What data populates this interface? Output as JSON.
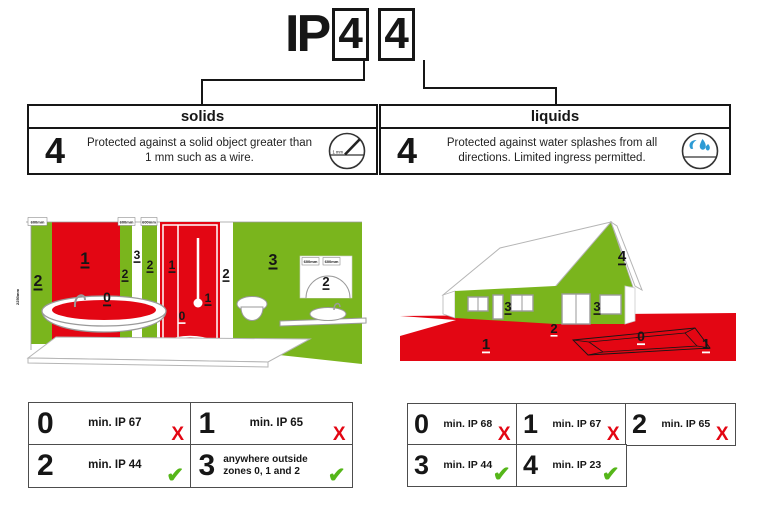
{
  "colors": {
    "red": "#e30613",
    "green": "#7ab51d",
    "blue": "#2d9bd5",
    "check_green": "#55b619",
    "cross_red": "#e30613"
  },
  "title": {
    "prefix": "IP",
    "digit_solids": "4",
    "digit_liquids": "4"
  },
  "panels": {
    "solids": {
      "header": "solids",
      "rating": "4",
      "description": "Protected against a solid object greater than 1 mm such as a wire.",
      "icon": "wire-gauge-icon",
      "icon_text": "1 mm"
    },
    "liquids": {
      "header": "liquids",
      "rating": "4",
      "description": "Protected against water splashes from all directions. Limited ingress permitted.",
      "icon": "water-splash-icon"
    }
  },
  "bathroom": {
    "height_label": "2250mm",
    "top_labels": [
      "600mm",
      "600mm",
      "600mm"
    ],
    "sink_labels": [
      "600mm",
      "600mm"
    ],
    "zones": {
      "left_wall": "2",
      "bath_wall": "1",
      "bath_water": "0",
      "mid_strip_left": "2",
      "mid_gap": "3",
      "mid_strip_right": "2",
      "shower_upper": "1",
      "shower_lower": "1",
      "shower_floor": "0",
      "beside_shower": "2",
      "room": "3",
      "sink_arc": "2"
    }
  },
  "house": {
    "zones": {
      "ground_left": "1",
      "ground_right": "1",
      "pit": "0",
      "base": "2",
      "side_wall": "3",
      "front_wall": "3",
      "gable": "4"
    }
  },
  "bathroom_table": {
    "rows": [
      {
        "zone": "0",
        "requirement": "min. IP 67",
        "allowed": false
      },
      {
        "zone": "1",
        "requirement": "min. IP 65",
        "allowed": false
      },
      {
        "zone": "2",
        "requirement": "min. IP 44",
        "allowed": true
      },
      {
        "zone": "3",
        "requirement": "anywhere outside zones 0, 1 and 2",
        "allowed": true
      }
    ]
  },
  "outdoor_table": {
    "rows": [
      {
        "zone": "0",
        "requirement": "min. IP 68",
        "allowed": false
      },
      {
        "zone": "1",
        "requirement": "min. IP 67",
        "allowed": false
      },
      {
        "zone": "2",
        "requirement": "min. IP 65",
        "allowed": false
      },
      {
        "zone": "3",
        "requirement": "min. IP 44",
        "allowed": true
      },
      {
        "zone": "4",
        "requirement": "min. IP 23",
        "allowed": true
      }
    ]
  },
  "marks": {
    "cross": "X",
    "check": "✔"
  }
}
